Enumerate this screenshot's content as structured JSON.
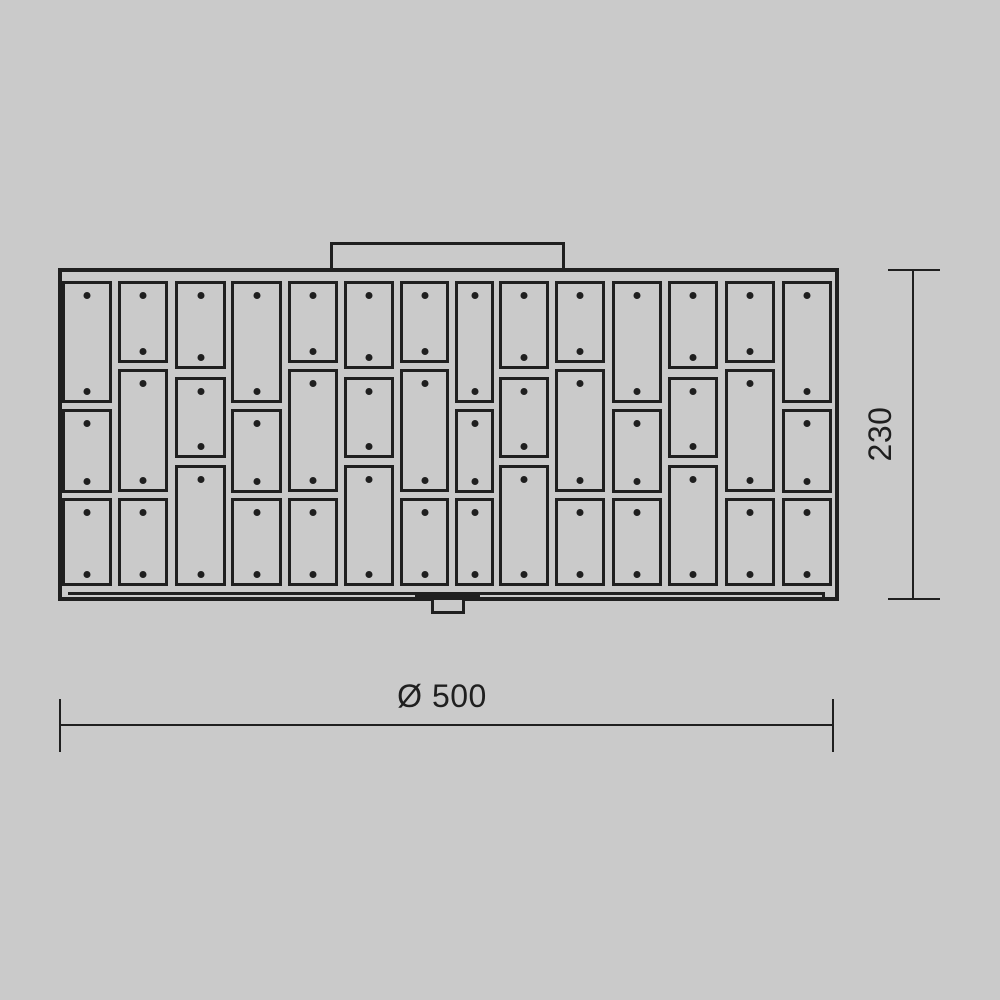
{
  "colors": {
    "background": "#cacaca",
    "line_color": "#1f1f1f",
    "panel_fill": "#cacaca"
  },
  "drawing": {
    "panel_grid": {
      "screw_dots_per_tile": 2,
      "columns": [
        {
          "x": 62,
          "width": 50,
          "type": "X"
        },
        {
          "x": 118,
          "width": 50,
          "type": "Y"
        },
        {
          "x": 175,
          "width": 51,
          "type": "Z"
        },
        {
          "x": 231,
          "width": 51,
          "type": "X"
        },
        {
          "x": 288,
          "width": 50,
          "type": "Y"
        },
        {
          "x": 344,
          "width": 50,
          "type": "Z"
        },
        {
          "x": 400,
          "width": 49,
          "type": "Y"
        },
        {
          "x": 455,
          "width": 39,
          "type": "X"
        },
        {
          "x": 499,
          "width": 50,
          "type": "Z"
        },
        {
          "x": 555,
          "width": 50,
          "type": "Y"
        },
        {
          "x": 612,
          "width": 50,
          "type": "X"
        },
        {
          "x": 668,
          "width": 50,
          "type": "Z"
        },
        {
          "x": 725,
          "width": 50,
          "type": "Y"
        },
        {
          "x": 782,
          "width": 50,
          "type": "X"
        }
      ],
      "tile_spans_by_type": {
        "X": [
          [
            281,
            403
          ],
          [
            409,
            493
          ],
          [
            498,
            586
          ]
        ],
        "Y": [
          [
            281,
            363
          ],
          [
            369,
            492
          ],
          [
            498,
            586
          ]
        ],
        "Z": [
          [
            281,
            369
          ],
          [
            377,
            458
          ],
          [
            465,
            586
          ]
        ]
      }
    }
  },
  "dimensions": {
    "height": {
      "label": "230"
    },
    "width": {
      "label": "Ø 500"
    }
  }
}
